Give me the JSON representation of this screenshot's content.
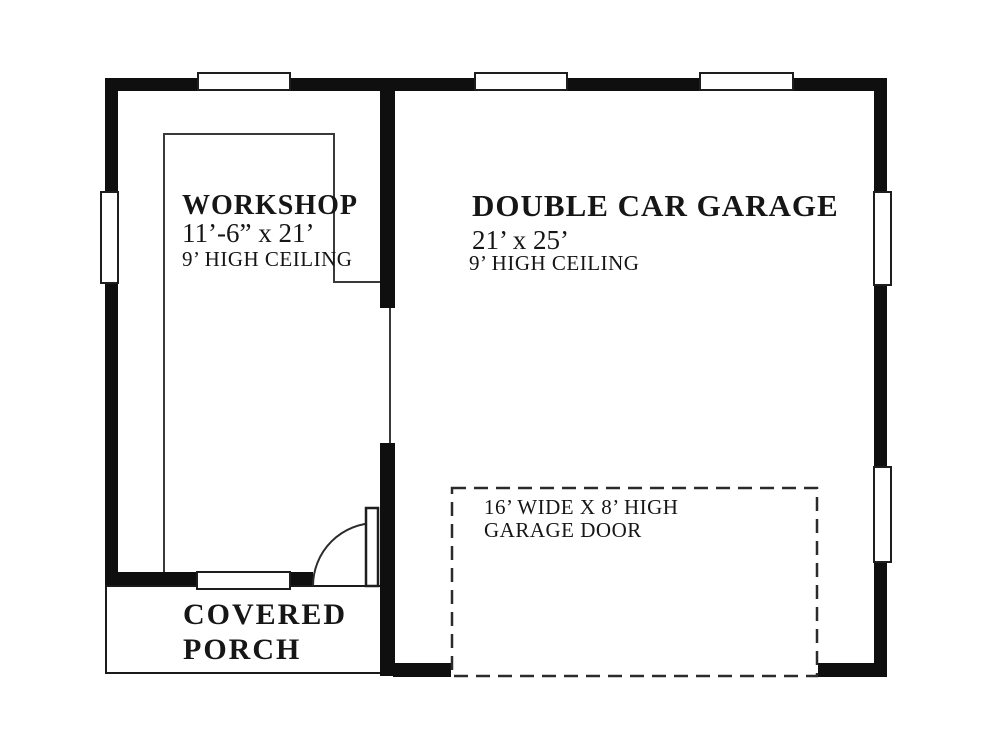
{
  "plan": {
    "workshop": {
      "name": "WORKSHOP",
      "dimensions": "11’-6” x 21’",
      "ceiling": "9’ HIGH CEILING"
    },
    "garage": {
      "name": "DOUBLE CAR GARAGE",
      "dimensions": "21’ x 25’",
      "ceiling": "9’ HIGH CEILING"
    },
    "garage_door": {
      "line1": "16’ WIDE X 8’ HIGH",
      "line2": "GARAGE DOOR"
    },
    "porch": {
      "line1": "COVERED",
      "line2": "PORCH"
    },
    "colors": {
      "wall": "#0f0f0f",
      "thin_line": "#3a3a3a",
      "background": "#ffffff"
    }
  }
}
